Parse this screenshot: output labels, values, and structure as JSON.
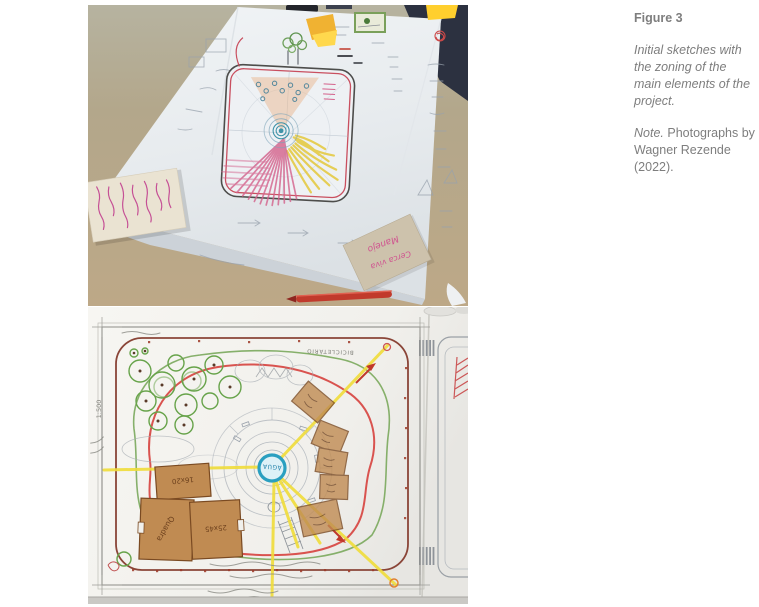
{
  "caption": {
    "figure_label": "Figure 3",
    "description": "Initial sketches with the zoning of the main elements of the project.",
    "note_prefix": "Note.",
    "note_body": " Photographs by Wagner Rezende (2022)."
  },
  "handwriting": {
    "water_label": "ÁGUA",
    "scale_label": "1:500",
    "court_label": "Quadra",
    "court_size": "25x45",
    "block_size": "16x20",
    "bike_label": "BICICLETÁRIO",
    "note_line1": "Manejo",
    "note_line2": "Cerca viva"
  },
  "colors": {
    "table": "#b3a78b",
    "paper": "#e9edf0",
    "sketch_red": "#c94f5f",
    "highlighter_yellow": "#f0dd3a",
    "kraft": "#c08b52",
    "magenta_ink": "#c2418f",
    "water_blue": "#2a9fc0",
    "tree_green": "#67a34a"
  }
}
